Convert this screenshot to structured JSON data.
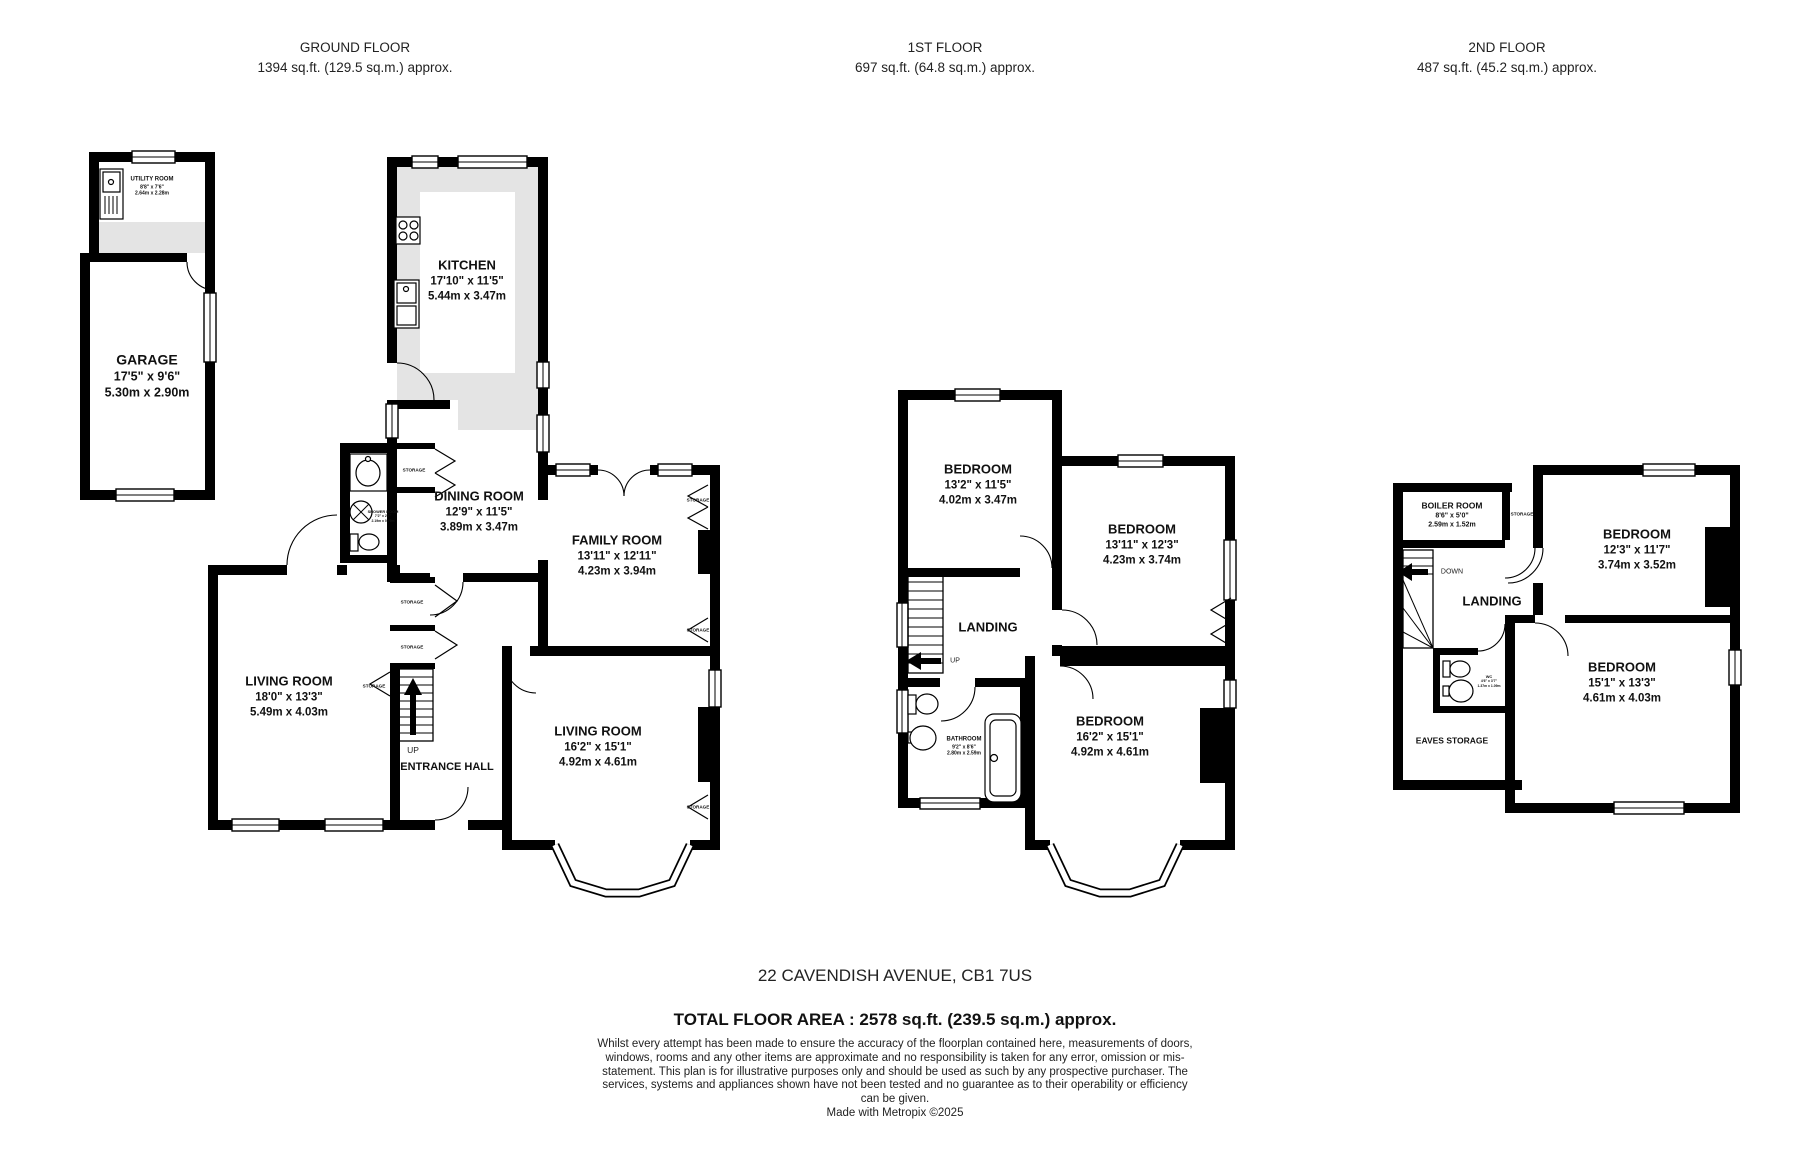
{
  "headers": [
    {
      "title": "GROUND FLOOR",
      "area": "1394 sq.ft. (129.5 sq.m.) approx."
    },
    {
      "title": "1ST FLOOR",
      "area": "697 sq.ft. (64.8 sq.m.) approx."
    },
    {
      "title": "2ND FLOOR",
      "area": "487 sq.ft. (45.2 sq.m.) approx."
    }
  ],
  "ground": {
    "utility": {
      "label": "UTILITY ROOM",
      "imperial": "8'8\" x 7'6\"",
      "metric": "2.64m x 2.28m"
    },
    "garage": {
      "label": "GARAGE",
      "imperial": "17'5\" x 9'6\"",
      "metric": "5.30m x 2.90m"
    },
    "kitchen": {
      "label": "KITCHEN",
      "imperial": "17'10\" x 11'5\"",
      "metric": "5.44m x 3.47m"
    },
    "dining": {
      "label": "DINING ROOM",
      "imperial": "12'9\" x 11'5\"",
      "metric": "3.89m x 3.47m"
    },
    "family": {
      "label": "FAMILY ROOM",
      "imperial": "13'11\" x 12'11\"",
      "metric": "4.23m x 3.94m"
    },
    "living1": {
      "label": "LIVING ROOM",
      "imperial": "18'0\" x 13'3\"",
      "metric": "5.49m x 4.03m"
    },
    "living2": {
      "label": "LIVING ROOM",
      "imperial": "16'2\" x 15'1\"",
      "metric": "4.92m x 4.61m"
    },
    "hall": {
      "label": "ENTRANCE HALL"
    },
    "shower": {
      "label": "SHOWER ROOM",
      "imperial": "7'2\" x 2'7\"",
      "metric": "2.19m x 0.79m"
    }
  },
  "first": {
    "bed1": {
      "label": "BEDROOM",
      "imperial": "13'2\" x 11'5\"",
      "metric": "4.02m x 3.47m"
    },
    "bed2": {
      "label": "BEDROOM",
      "imperial": "13'11\" x 12'3\"",
      "metric": "4.23m x 3.74m"
    },
    "bed3": {
      "label": "BEDROOM",
      "imperial": "16'2\" x 15'1\"",
      "metric": "4.92m x 4.61m"
    },
    "landing": {
      "label": "LANDING"
    },
    "bathroom": {
      "label": "BATHROOM",
      "imperial": "9'2\" x 8'6\"",
      "metric": "2.80m x 2.59m"
    }
  },
  "second": {
    "boiler": {
      "label": "BOILER ROOM",
      "imperial": "8'6\" x 5'0\"",
      "metric": "2.59m x 1.52m"
    },
    "bed4": {
      "label": "BEDROOM",
      "imperial": "12'3\" x 11'7\"",
      "metric": "3.74m x 3.52m"
    },
    "bed5": {
      "label": "BEDROOM",
      "imperial": "15'1\" x 13'3\"",
      "metric": "4.61m x 4.03m"
    },
    "landing": {
      "label": "LANDING"
    },
    "eaves": {
      "label": "EAVES STORAGE"
    },
    "wc": {
      "label": "WC",
      "imperial": "4'6\" x 3'7\"",
      "metric": "1.37m x 1.09m"
    }
  },
  "labels": {
    "storage": "STORAGE",
    "up": "UP",
    "down": "DOWN"
  },
  "footer": {
    "address": "22 CAVENDISH AVENUE, CB1 7US",
    "total": "TOTAL FLOOR AREA : 2578 sq.ft. (239.5 sq.m.) approx.",
    "disclaimer": "Whilst every attempt has been made to ensure the accuracy of the floorplan contained here, measurements of doors, windows, rooms and any other items are approximate and no responsibility is taken for any error, omission or mis-statement. This plan is for illustrative purposes only and should be used as such by any prospective purchaser. The services, systems and appliances shown have not been tested and no guarantee as to their operability or efficiency can be given.",
    "credit": "Made with Metropix ©2025"
  },
  "colors": {
    "wall": "#000000",
    "units_grey": "#e4e4e4",
    "background": "#ffffff"
  }
}
